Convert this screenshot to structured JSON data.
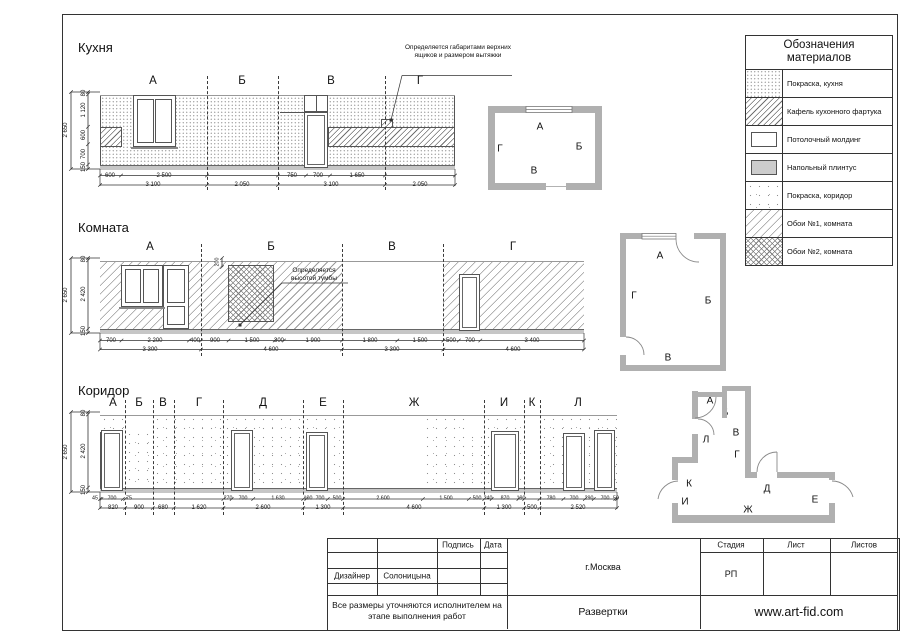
{
  "kitchen": {
    "title": "Кухня",
    "section_labels": [
      "А",
      "Б",
      "В",
      "Г"
    ],
    "annotation": "Определяется габаритами верхних ящиков и размером вытяжки",
    "dims_left": [
      "80",
      "1 120",
      "600",
      "700",
      "150"
    ],
    "dim_total": "2 650",
    "dims_row1": [
      "600",
      "2 500",
      "750",
      "700",
      "1 650"
    ],
    "dims_row2": [
      "3 100",
      "2 050",
      "3 100",
      "2 050"
    ]
  },
  "room": {
    "title": "Комната",
    "section_labels": [
      "А",
      "Б",
      "В",
      "Г"
    ],
    "annotation": "Определяется высотой тумбы",
    "dim_cabinet": "200",
    "dims_left": [
      "80",
      "2 420",
      "150"
    ],
    "dim_total": "2 650",
    "dims_row1": [
      "700",
      "2 200",
      "400",
      "900",
      "1 500",
      "300",
      "1 900",
      "1 800",
      "1 500",
      "500",
      "700",
      "3 400"
    ],
    "dims_row2": [
      "3 300",
      "4 600",
      "3 300",
      "4 600"
    ]
  },
  "corridor": {
    "title": "Коридор",
    "section_labels": [
      "А",
      "Б",
      "В",
      "Г",
      "Д",
      "Е",
      "Ж",
      "И",
      "К",
      "Л"
    ],
    "dims_left": [
      "80",
      "2 420",
      "150"
    ],
    "dim_total": "2 650",
    "dims_row1": [
      "45",
      "700",
      "75",
      "270",
      "700",
      "1 630",
      "100",
      "700",
      "500",
      "2 600",
      "1 500",
      "500",
      "240",
      "870",
      "190",
      "780",
      "700",
      "290",
      "700",
      "50"
    ],
    "dims_row2": [
      "820",
      "900",
      "680",
      "1 620",
      "2 600",
      "1 300",
      "4 600",
      "1 300",
      "500",
      "2 520"
    ]
  },
  "legend": {
    "title": "Обозначения материалов",
    "items": [
      {
        "label": "Покраска, кухня",
        "pattern": "dots-fine"
      },
      {
        "label": "Кафель кухонного фартука",
        "pattern": "hatch-dense"
      },
      {
        "label": "Потолочный молдинг",
        "pattern": "white-inset"
      },
      {
        "label": "Напольный плинтус",
        "pattern": "gray-inset"
      },
      {
        "label": "Покраска, коридор",
        "pattern": "dots-sparse"
      },
      {
        "label": "Обои №1, комната",
        "pattern": "hatch-light"
      },
      {
        "label": "Обои №2, комната",
        "pattern": "crosshatch"
      }
    ]
  },
  "titleblock": {
    "signature_label": "Подпись",
    "date_label": "Дата",
    "designer_label": "Дизайнер",
    "designer_name": "Солоницына",
    "note": "Все размеры уточняются исполнителем на этапе выполнения работ",
    "city": "г.Москва",
    "doc_title": "Развертки",
    "stage_label": "Стадия",
    "sheet_label": "Лист",
    "sheets_label": "Листов",
    "stage_value": "РП",
    "website": "www.art-fid.com"
  }
}
